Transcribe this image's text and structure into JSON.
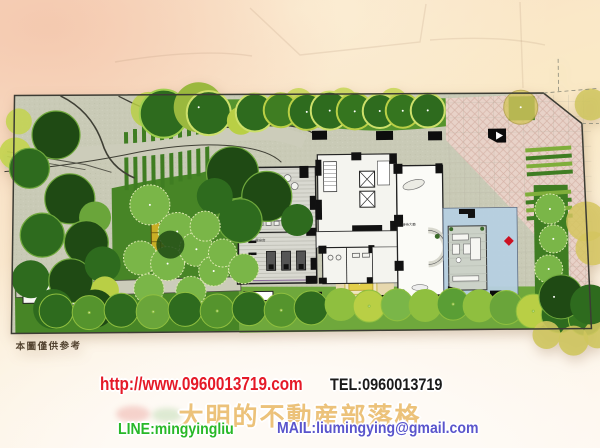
{
  "plan": {
    "disclaimer": "本圖僅供参考",
    "room_labels": {
      "lounge": "交誼廳",
      "gym": "健身房",
      "lobby": "接待大廳"
    }
  },
  "footer": {
    "url": "http://www.0960013719.com",
    "tel": "TEL:0960013719",
    "blog_title": "大明的不動産部落格",
    "line": "LINE:mingyingliu",
    "mail": "MAIL:liumingying@gmail.com"
  },
  "colors": {
    "url_red": "#e51a28",
    "tel_black": "#1b1b1b",
    "title_gold": "#ecc27a",
    "line_green": "#28b828",
    "mail_blue": "#5a55cc",
    "paper": "#c9cab6",
    "lawn_green": "#478526",
    "tree_dark": "#2e6b1e",
    "tree_chartreuse": "#b9cf45",
    "tree_olive": "#d5c65f",
    "driveway_pink": "#e8d2c8",
    "water_blue": "#b7d0e2",
    "plaza_yellow": "#e3cf4a",
    "pavilion_yellow": "#c9ae25",
    "marker_red": "#dd1515"
  }
}
